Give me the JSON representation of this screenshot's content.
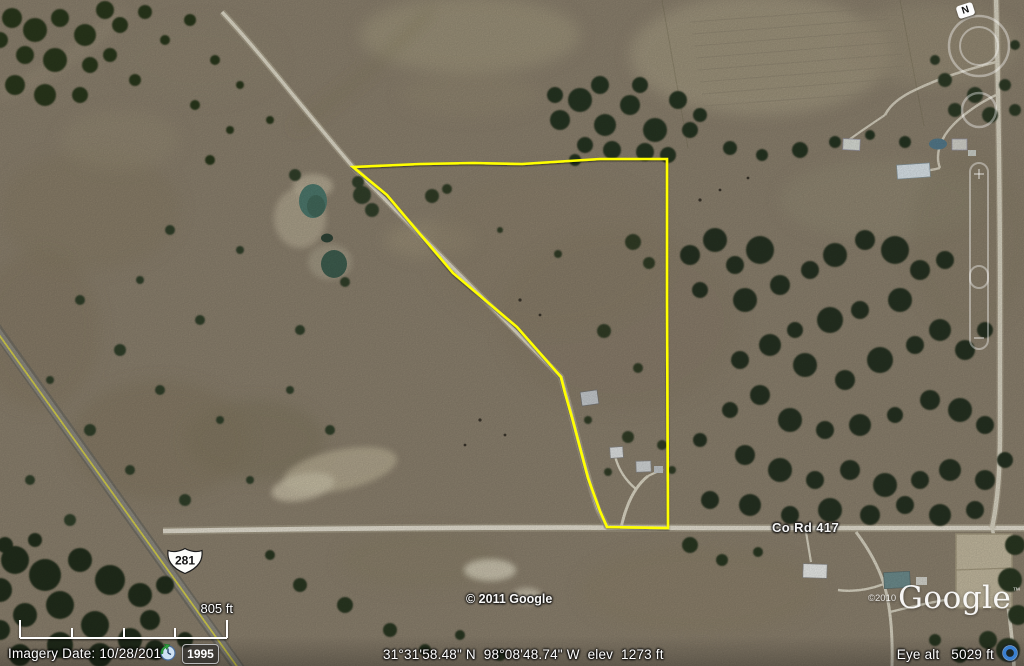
{
  "status_bar": {
    "imagery_date": "Imagery Date: 10/28/2010",
    "time_slider_year": "1995",
    "coordinates": "31°31'58.48\" N  98°08'48.74\" W  elev  1273 ft",
    "eye_altitude": "Eye alt   5029 ft"
  },
  "map_overlays": {
    "scale_label": "805 ft",
    "center_copyright": "© 2011 Google",
    "logo_copyright": "©2010",
    "logo_text": "Google",
    "logo_trademark": "™",
    "compass_north_label": "N",
    "route_shield_281": "281",
    "road_name": "Co Rd 417"
  },
  "colors": {
    "parcel_outline": "#ffff00",
    "highway_stripe": "#d8d24e",
    "status_text": "#ffffff"
  }
}
